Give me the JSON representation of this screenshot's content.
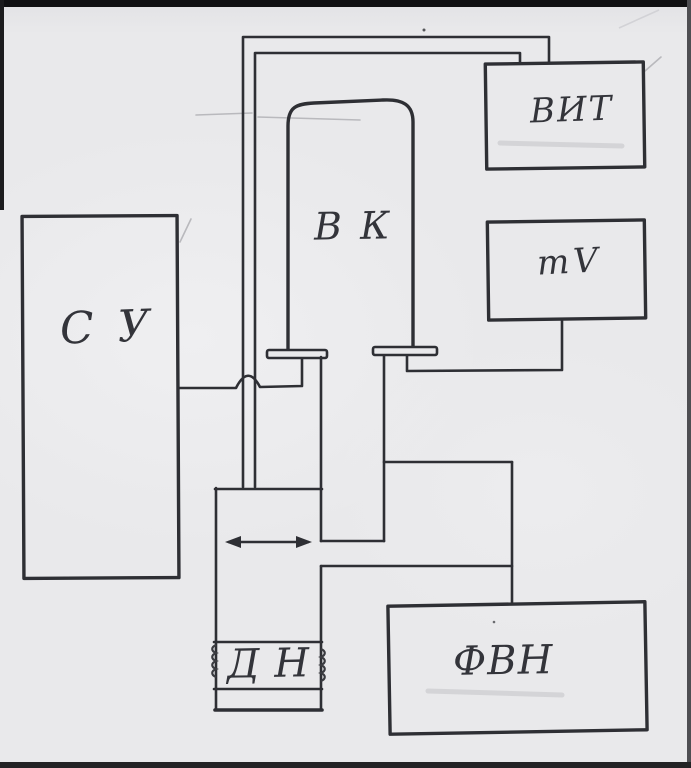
{
  "scan": {
    "paper_color": "#e9e9eb",
    "ink_color": "#2e2f34"
  },
  "blocks": {
    "su": {
      "label": "С У"
    },
    "vk": {
      "label": "В К"
    },
    "vit": {
      "label": "ВИТ"
    },
    "mv": {
      "label": "mV"
    },
    "dn": {
      "label": "Д Н"
    },
    "fvn": {
      "label": "ФВН"
    }
  }
}
